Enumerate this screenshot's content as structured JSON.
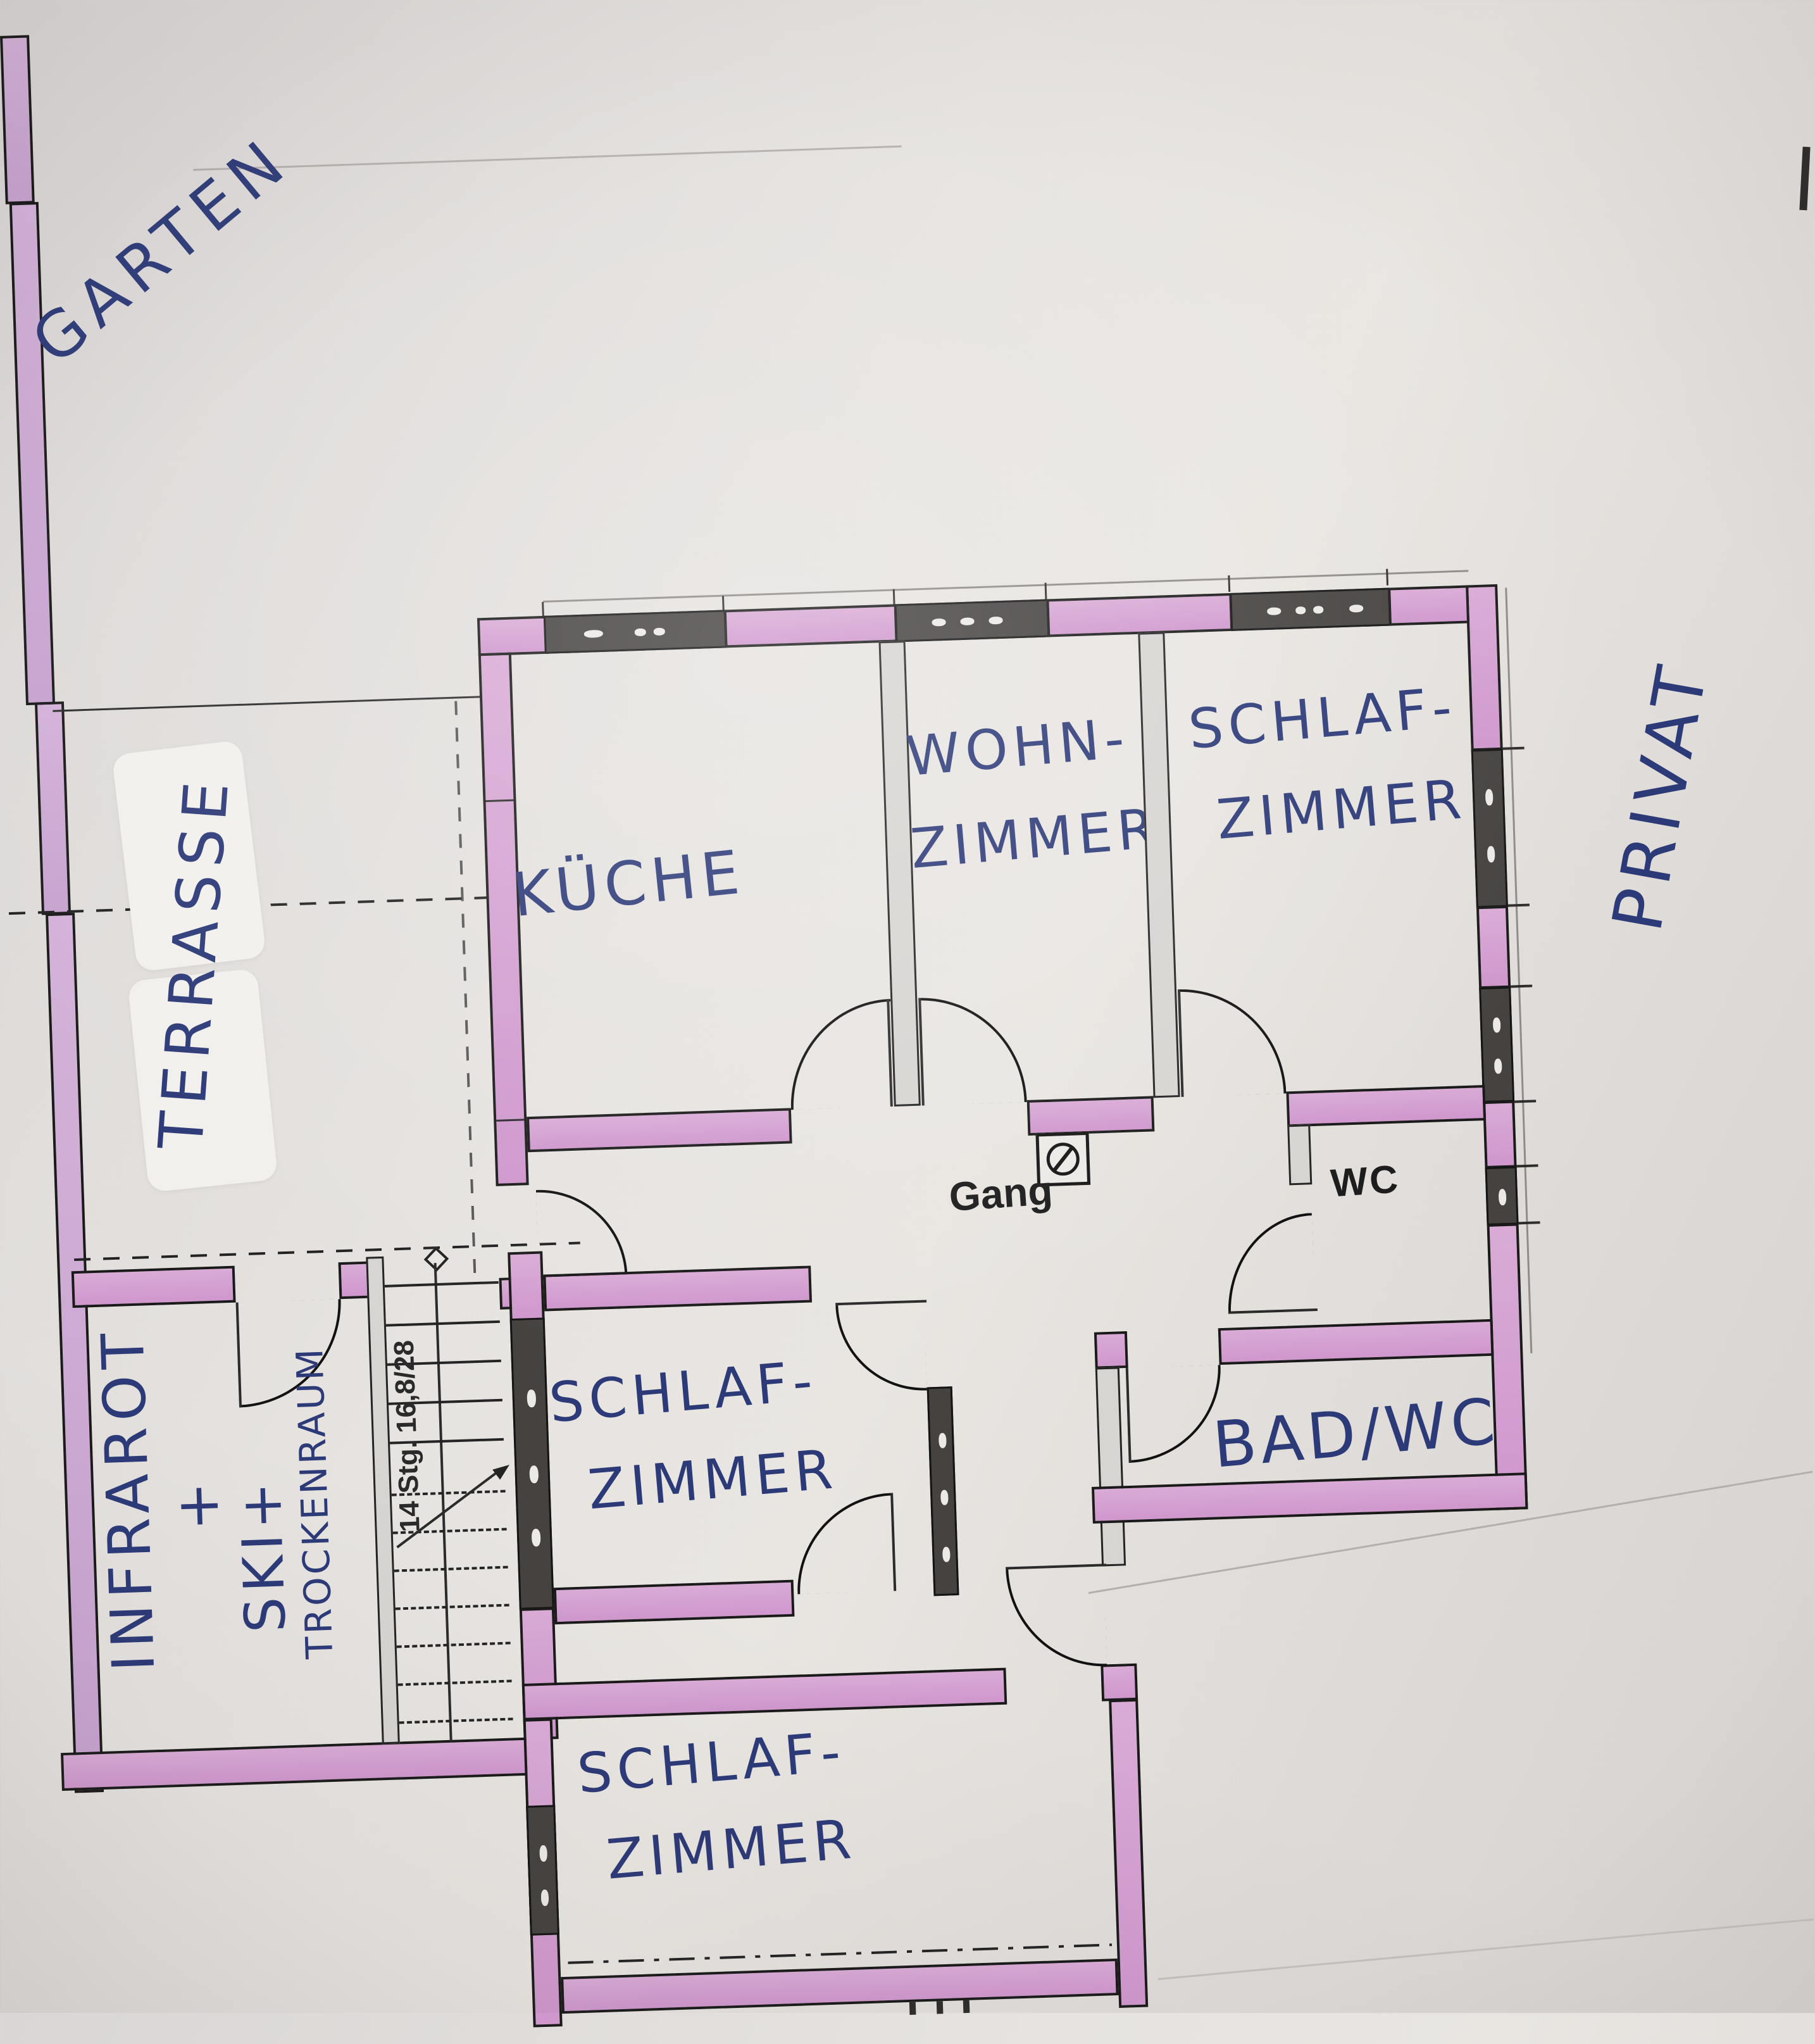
{
  "document": {
    "kind": "hand-annotated floor plan scan",
    "language": "German"
  },
  "colors": {
    "paper": "#e3e0dd",
    "wall_fill_pink": "#d2a0d0",
    "wall_fill_lavender": "#ccaad3",
    "outline_black": "#1b1a1a",
    "window_dark": "#454240",
    "ink_blue": "#2c3a78",
    "ink_black": "#1d1d1d"
  },
  "outdoor_labels": {
    "garten": "GARTEN",
    "terrasse": "TERRASSE",
    "privat": "PRIVAT"
  },
  "rooms": {
    "kueche": {
      "label": "KÜCHE"
    },
    "wohnzimmer": {
      "line1": "WOHN-",
      "line2": "ZIMMER"
    },
    "schlafzimmer_nordost": {
      "line1": "SCHLAF-",
      "line2": "ZIMMER"
    },
    "schlafzimmer_mitte": {
      "line1": "SCHLAF-",
      "line2": "ZIMMER"
    },
    "schlafzimmer_sued": {
      "line1": "SCHLAF-",
      "line2": "ZIMMER"
    },
    "bad_wc": {
      "label": "BAD/WC"
    },
    "wc": {
      "label": "WC"
    },
    "gang": {
      "label": "Gang"
    },
    "infrarot_raum": {
      "line1": "INFRAROT",
      "line2": "+",
      "line3": "SKI+",
      "line4": "TROCKENRAUM"
    }
  },
  "stairs": {
    "label": "14 Stg. 16,8/28",
    "steps_solid": 5,
    "steps_dashed": 7
  },
  "icons": {
    "gang_shaft": "circle-slash-symbol",
    "stair_newel": "diamond-symbol",
    "stair_direction": "arrow-line"
  }
}
